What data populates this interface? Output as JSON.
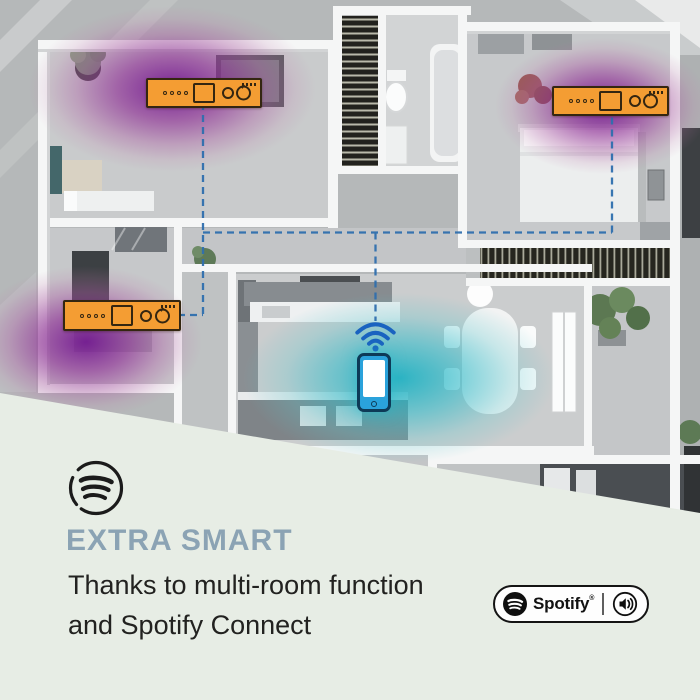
{
  "scene": {
    "description": "isometric apartment floor plan with three multi-room speakers and a smartphone",
    "colors": {
      "background_gray": "#b5b8b9",
      "speaker_orange": "#f49d33",
      "coverage_purple": "#8c2a96",
      "coverage_teal": "#2ab4c4",
      "phone_blue": "#2aa2db",
      "wifi_blue": "#1a63c0",
      "connection_line_blue": "#2f6fae"
    },
    "devices": [
      {
        "id": "speaker-top-left"
      },
      {
        "id": "speaker-top-right"
      },
      {
        "id": "speaker-mid-left"
      }
    ]
  },
  "panel": {
    "background_color": "#e7ede5",
    "heading": "EXTRA SMART",
    "heading_color": "#8ba3b4",
    "description_line1": "Thanks to multi-room function",
    "description_line2": "and Spotify Connect",
    "badge": {
      "brand": "Spotify",
      "registered_mark": "®"
    }
  }
}
